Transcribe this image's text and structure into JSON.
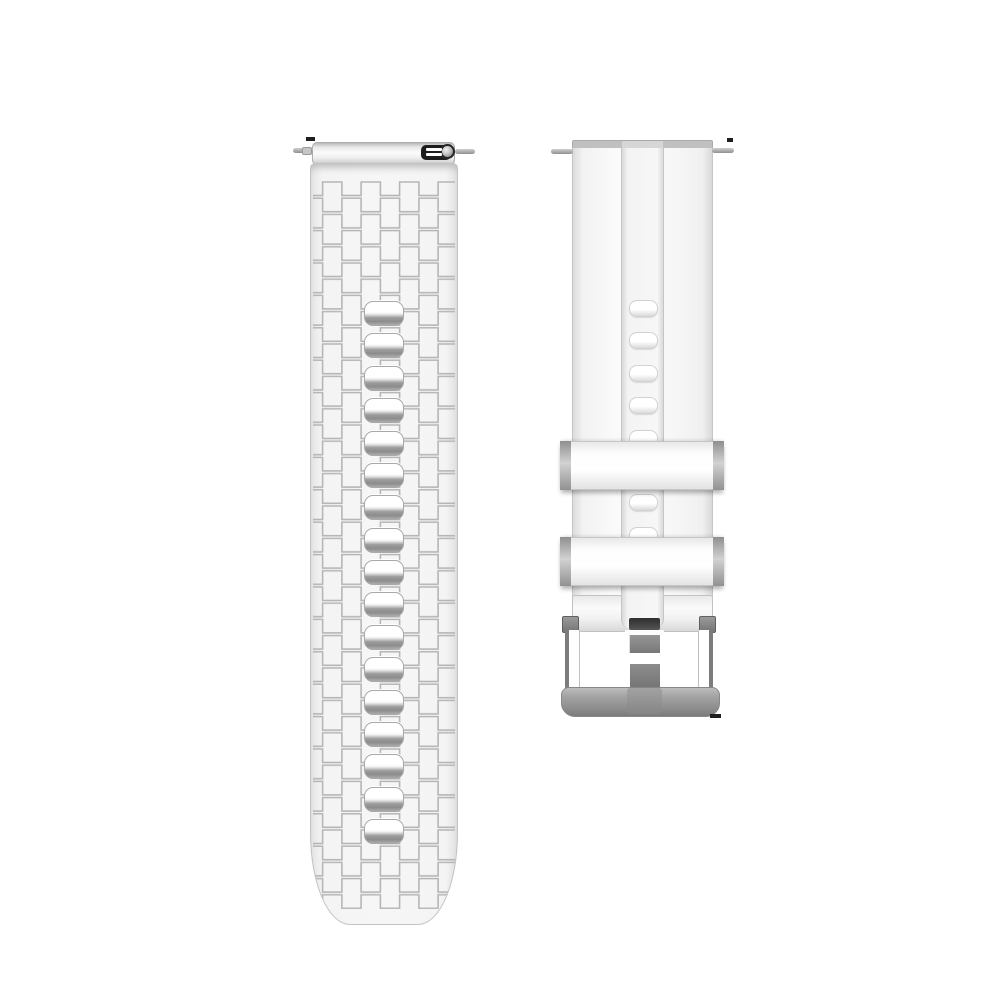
{
  "canvas": {
    "width": 1000,
    "height": 1000,
    "background": "#ffffff"
  },
  "product": {
    "type": "silicone-watch-band",
    "color_scheme": {
      "band_white": "#f6f6f6",
      "band_edge": "#c2c2c2",
      "texture_line": "#b6b6b6",
      "hole_shadow": "#8c8c8c",
      "metal_silver": "#9a9a9a",
      "buckle_dark": "#5f5f5f",
      "quick_release_black": "#1d1d1d"
    },
    "left_strap": {
      "x": 310,
      "y": 142,
      "width": 148,
      "bottom": 925,
      "pins": [
        {
          "x": 293,
          "y": 148,
          "w": 20,
          "h": 5
        },
        {
          "x": 455,
          "y": 149,
          "w": 20,
          "h": 5
        }
      ],
      "pin_nub": {
        "x": 302,
        "y": 147,
        "w": 10,
        "h": 8
      },
      "quick_release_slots_y": [
        148,
        153
      ],
      "holes": {
        "count": 17,
        "x": 363,
        "width": 40,
        "height": 25,
        "start_y": 300,
        "step": 32.375
      }
    },
    "right_strap": {
      "x": 572,
      "y": 140,
      "width": 141,
      "pins": [
        {
          "x": 551,
          "y": 149,
          "w": 22,
          "h": 5
        },
        {
          "x": 712,
          "y": 148,
          "w": 22,
          "h": 5
        }
      ],
      "channel": {
        "x": 621,
        "width": 43
      },
      "holes": {
        "count": 8,
        "x": 629,
        "width": 29,
        "height": 17,
        "start_y": 300,
        "step": 32.4
      },
      "keepers": [
        {
          "x": 560,
          "y": 441,
          "width": 164,
          "height": 49
        },
        {
          "x": 560,
          "y": 537,
          "width": 164,
          "height": 49
        }
      ]
    },
    "artifacts": [
      {
        "x": 306,
        "y": 137,
        "w": 9,
        "h": 4
      },
      {
        "x": 727,
        "y": 138,
        "w": 6,
        "h": 4
      },
      {
        "x": 710,
        "y": 714,
        "w": 11,
        "h": 4
      }
    ],
    "texture": {
      "tile_w": 38.5,
      "tile_h": 32.4,
      "stroke": "#b6b6b6",
      "stroke_width": 1.6
    }
  }
}
